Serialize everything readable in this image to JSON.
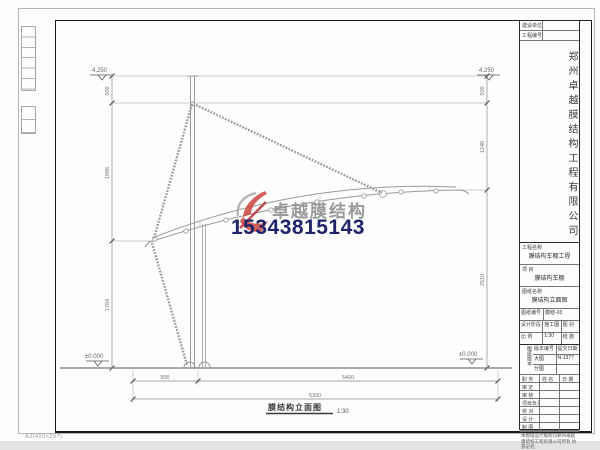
{
  "page": {
    "paper_note": "A3(420×297)"
  },
  "watermark": {
    "brand": "卓越膜结构",
    "phone": "15343815143",
    "brand_color": "#8f8f8f",
    "phone_color": "#20246a",
    "logo_red": "#c9433d"
  },
  "drawing": {
    "caption": "膜结构立面图",
    "scale": "1:30",
    "elev_top_left": "4.250",
    "elev_top_right": "4.250",
    "elev_ground_left": "±0.000",
    "elev_ground_right": "±0.000",
    "dims_left": [
      "500",
      "1986",
      "1764"
    ],
    "dims_right": [
      "500",
      "1240",
      "2510"
    ],
    "dims_bottom": [
      "900",
      "5400"
    ],
    "dim_total": "6300"
  },
  "title_block": {
    "owner_label": "建设单位",
    "project_no_label": "工程编号",
    "company": "郑州卓越膜结构工程有限公司",
    "project_name_label": "工程名称",
    "project_name": "膜结构车棚工程",
    "item_label": "项  目",
    "item": "膜结构车棚",
    "sheet_name_label": "图纸名称",
    "sheet_name": "膜结构立面图",
    "meta": {
      "no_label": "图纸编号",
      "no": "膜结-03",
      "stage_label": "设计阶段",
      "stage": "施工图",
      "type_label": "图 别",
      "type": "结 施",
      "scale_label": "比 例",
      "scale": "1:30"
    },
    "version": {
      "block_label": "图纸版本",
      "r1c1": "版本编号",
      "r1c2": "提交日期",
      "r2c1": "大图",
      "r2c2": "N-1377",
      "r3c1": "分图",
      "r3c2": ""
    },
    "sign_header": [
      "职 务",
      "姓 名",
      "日 期"
    ],
    "sign_rows": [
      "审 定",
      "审 核",
      "项目负责",
      "校 对",
      "设 计",
      "制 图"
    ],
    "note": "本图纸设计版权归郑州卓越膜结构工程有限公司所有 仿冒必究"
  }
}
